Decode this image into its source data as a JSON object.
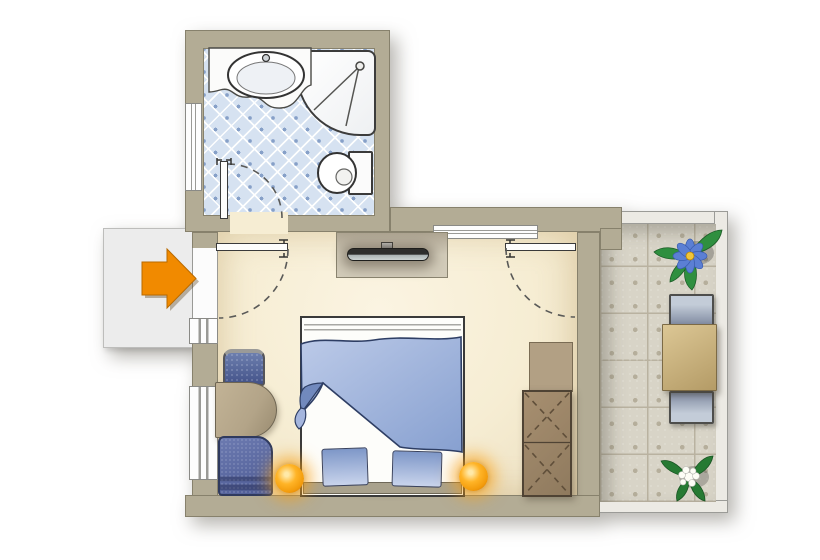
{
  "meta": {
    "title": "Apartment floor plan",
    "type": "floor-plan"
  },
  "colors": {
    "wall": "#b3ac95",
    "wall_outline": "#87816c",
    "room_floor": "#f6edd3",
    "bath_tile": "#d6e2f1",
    "bath_dot": "#86a0c8",
    "hallway": "#ececec",
    "entrance_arrow": "#f18a00",
    "terrace_tile": "#d8d4c7",
    "terrace_groove": "#b9b2a0",
    "railing": "#eceae4",
    "duvet": "#8aa2d2",
    "pillow": "#a9bcdf",
    "lamp_glow": "#f39c0c",
    "wardrobe_wood": "#8f7a5e",
    "desk_wood": "#b3a488",
    "armchair_blue": "#4f5d96",
    "terrace_table": "#b49b66",
    "terrace_chair": "#7f8aa0",
    "tv_dark": "#2e2e2c"
  },
  "entrance": {
    "symbol": "arrow-right-icon",
    "meaning": "apartment entrance"
  },
  "bathroom": {
    "name": "bathroom",
    "floor": "blue diamond tiles",
    "fixtures": [
      "washbasin",
      "shower",
      "toilet",
      "window",
      "door"
    ]
  },
  "main_room": {
    "name": "bedroom-living-area",
    "floor": "cream",
    "furniture": [
      "tv-console",
      "flat-tv",
      "double-bed",
      "pillow",
      "pillow",
      "bedside-lamp",
      "bedside-lamp",
      "desk",
      "desk-chair",
      "armchair",
      "wardrobe",
      "cabinet"
    ],
    "windows": [
      "left-small",
      "left-large",
      "top"
    ],
    "doors": [
      "entrance-door",
      "bathroom-door",
      "terrace-door"
    ]
  },
  "terrace": {
    "name": "terrace",
    "floor": "ornamental stone tiles",
    "furniture": [
      "table",
      "chair",
      "chair"
    ],
    "plants": [
      "blue-flower-plant",
      "white-flower-plant"
    ]
  }
}
